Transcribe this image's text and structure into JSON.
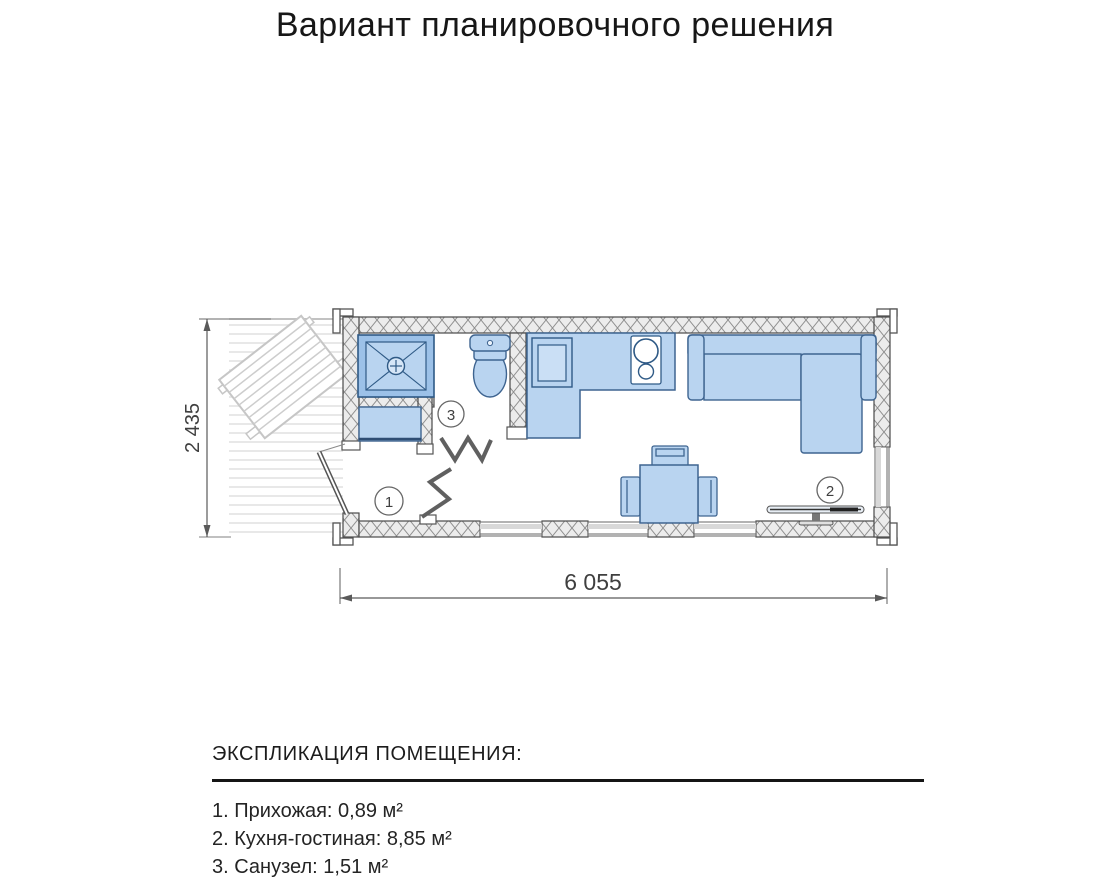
{
  "title": "Вариант планировочного решения",
  "plan": {
    "dim_width_label": "6 055",
    "dim_height_label": "2 435",
    "room_numbers": {
      "hall": "1",
      "kitchen_living": "2",
      "bathroom": "3"
    }
  },
  "legend": {
    "heading": "ЭКСПЛИКАЦИЯ ПОМЕЩЕНИЯ:",
    "items": [
      "1. Прихожая: 0,89 м²",
      "2. Кухня-гостиная: 8,85 м²",
      "3. Санузел: 1,51 м²"
    ]
  },
  "colors": {
    "furniture_fill": "#b9d4f0",
    "furniture_fill_light": "#cadff5",
    "furniture_stroke": "#3e6490",
    "wall_hatch": "#8f8f8f",
    "dimension_line": "#5a5a5a",
    "text": "#1f1f1f"
  }
}
